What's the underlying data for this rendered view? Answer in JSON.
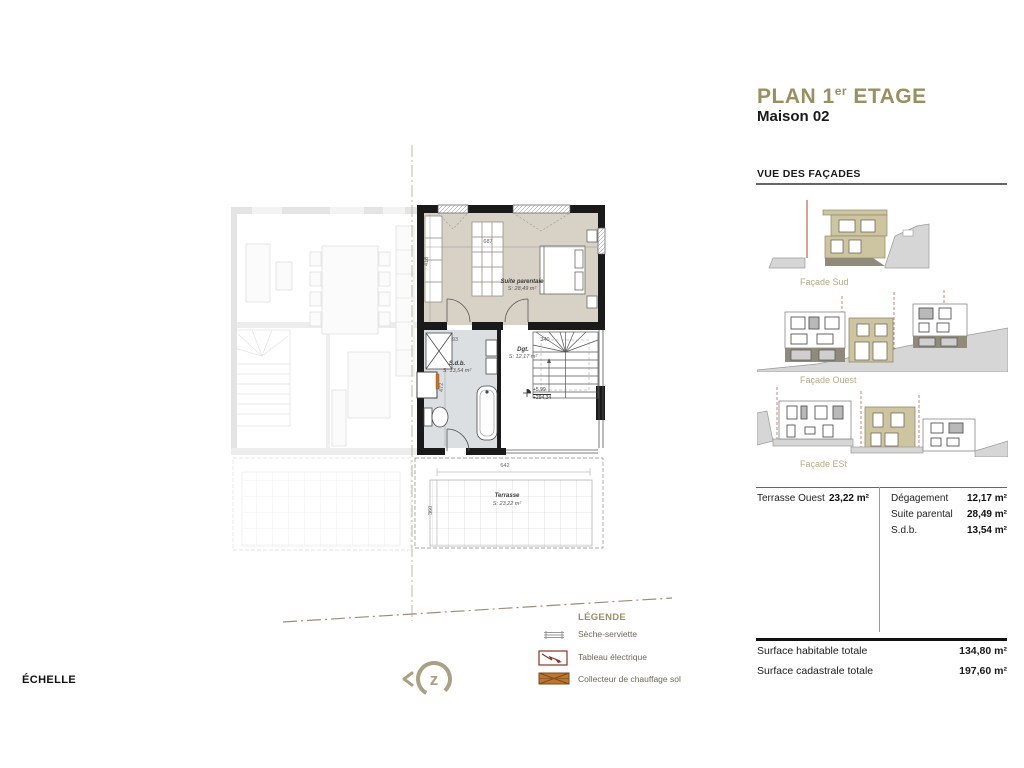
{
  "header": {
    "title_prefix": "PLAN 1",
    "title_sup": "er",
    "title_suffix": " ETAGE",
    "subtitle": "Maison 02"
  },
  "facades": {
    "heading": "VUE DES FAÇADES",
    "labels": [
      "Façade Sud",
      "Façade Ouest",
      "Façade ESt"
    ]
  },
  "areas": {
    "left": [
      {
        "name": "Terrasse Ouest",
        "value": "23,22 m²"
      }
    ],
    "right": [
      {
        "name": "Dégagement",
        "value": "12,17 m²"
      },
      {
        "name": "Suite parental",
        "value": "28,49 m²"
      },
      {
        "name": "S.d.b.",
        "value": "13,54 m²"
      }
    ]
  },
  "totals": [
    {
      "name": "Surface habitable totale",
      "value": "134,80 m²"
    },
    {
      "name": "Surface cadastrale totale",
      "value": "197,60 m²"
    }
  ],
  "legend": {
    "heading": "LÉGENDE",
    "items": [
      {
        "icon": "towel-radiator-icon",
        "label": "Sèche-serviette"
      },
      {
        "icon": "electrical-panel-icon",
        "label": "Tableau électrique"
      },
      {
        "icon": "floor-heating-collector-icon",
        "label": "Collecteur de chauffage sol"
      }
    ]
  },
  "scale_label": "ÉCHELLE",
  "plan": {
    "rooms": {
      "suite": {
        "name": "Suite parentale",
        "area": "S: 28,49 m²"
      },
      "sdb": {
        "name": "S.d.b.",
        "area": "S: 13,54 m²"
      },
      "dgt": {
        "name": "Dgt.",
        "area": "S: 12,17 m²"
      },
      "terrasse": {
        "name": "Terrasse",
        "area": "S: 23,22 m²"
      }
    },
    "dimensions": {
      "suite_width": "687",
      "suite_depth": "418",
      "sdb_depth": "472",
      "sdb_width": "93",
      "stair_width": "340",
      "terrace_width": "642",
      "terrace_depth": "360"
    },
    "level_marker": {
      "relative": "+5,99",
      "absolute": "+294,34"
    }
  },
  "colors": {
    "accent_khaki": "#99905f",
    "facade_label": "#b4ab84",
    "suite_floor": "#d8d1c5",
    "bath_floor": "#dcdfe2",
    "ground_gray": "#d6d6d6",
    "heating_orange": "#c0762f",
    "electric_red": "#8c3326"
  }
}
